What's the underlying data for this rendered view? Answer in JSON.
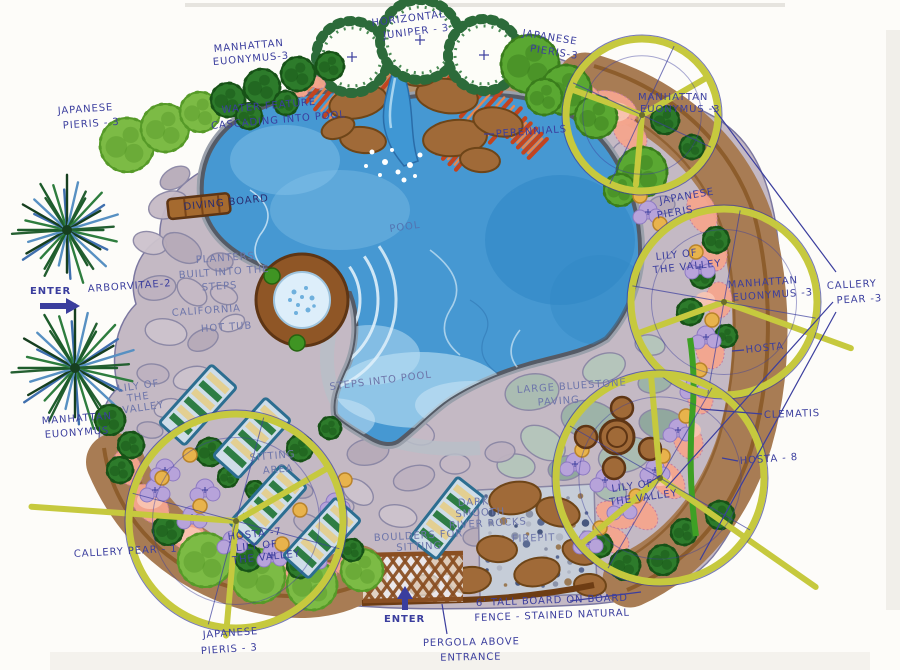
{
  "plan_title": "Backyard pool landscape concept plan",
  "colors": {
    "ink": "#3b3e9e",
    "pool_water": "#4698d2",
    "tree_ring_yellow": "#c6c93e",
    "paving_mauve": "#c4b9c4",
    "bed_soil_brown": "#a87c54",
    "salmon_flowers": "#f5a68e",
    "boulder_brown": "#a06a38"
  },
  "labels": {
    "manhattan_euonymus_top": {
      "l1": "MANHATTAN",
      "l2": "EUONYMUS-3"
    },
    "horizontal_juniper": {
      "l1": "HORIZONTAL",
      "l2": "JUNIPER - 3"
    },
    "japanese_pieris_top_right": {
      "l1": "JAPANESE",
      "l2": "PIERIS-3"
    },
    "water_feature": {
      "l1": "WATER FEATURE",
      "l2": "CASCADING INTO POOL"
    },
    "perennials": {
      "l1": "PERENNIALS"
    },
    "japanese_pieris_left": {
      "l1": "JAPANESE",
      "l2": "PIERIS - 3"
    },
    "manhattan_euonymus_top_right": {
      "l1": "MANHATTAN",
      "l2": "EUONYMUS -3"
    },
    "diving_board": {
      "l1": "DIVING BOARD"
    },
    "pool": {
      "l1": "POOL"
    },
    "japanese_pieris_right": {
      "l1": "JAPANESE",
      "l2": "PIERIS"
    },
    "planters": {
      "l1": "PLANTERS",
      "l2": "BUILT INTO THE",
      "l3": "STEPS"
    },
    "arborvitae": {
      "l1": "ARBORVITAE-2"
    },
    "enter_left": {
      "l1": "ENTER"
    },
    "california_hot_tub": {
      "l1": "CALIFORNIA",
      "l2": "HOT TUB"
    },
    "lily_of_the_valley_right": {
      "l1": "LILY OF",
      "l2": "THE VALLEY"
    },
    "manhattan_euonymus_right": {
      "l1": "MANHATTAN",
      "l2": "EUONYMUS -3"
    },
    "callery_pear_right": {
      "l1": "CALLERY",
      "l2": "PEAR -3"
    },
    "hosta_right": {
      "l1": "HOSTA"
    },
    "clematis": {
      "l1": "CLEMATIS"
    },
    "hosta_8": {
      "l1": "HOSTA - 8"
    },
    "lily_of_the_valley_left": {
      "l1": "LILY OF",
      "l2": "THE",
      "l3": "VALLEY"
    },
    "manhattan_euonymus_bottom_left": {
      "l1": "MANHATTAN",
      "l2": "EUONYMUS"
    },
    "steps_into_pool": {
      "l1": "STEPS INTO POOL"
    },
    "large_bluestone": {
      "l1": "LARGE BLUESTONE",
      "l2": "PAVING"
    },
    "sitting_area": {
      "l1": "SITTING",
      "l2": "AREA"
    },
    "lily_of_the_valley_bottom_right": {
      "l1": "LILY OF",
      "l2": "THE VALLEY"
    },
    "hosta_lily_bottom": {
      "l1": "HOSTA -7",
      "l2": "LILY OF",
      "l3": "THE VALLEY"
    },
    "callery_pear_bottom_left": {
      "l1": "CALLERY PEAR - 1"
    },
    "dark_rocks": {
      "l1": "DARK",
      "l2": "SMOOTH",
      "l3": "RIVER ROCKS"
    },
    "firepit": {
      "l1": "FIREPIT"
    },
    "boulders": {
      "l1": "BOULDERS FOR",
      "l2": "SITTING"
    },
    "enter_bottom": {
      "l1": "ENTER"
    },
    "fence": {
      "l1": "6' TALL BOARD ON BOARD",
      "l2": "FENCE - STAINED NATURAL"
    },
    "pergola": {
      "l1": "PERGOLA ABOVE",
      "l2": "ENTRANCE"
    },
    "japanese_pieris_bottom": {
      "l1": "JAPANESE",
      "l2": "PIERIS - 3"
    }
  }
}
